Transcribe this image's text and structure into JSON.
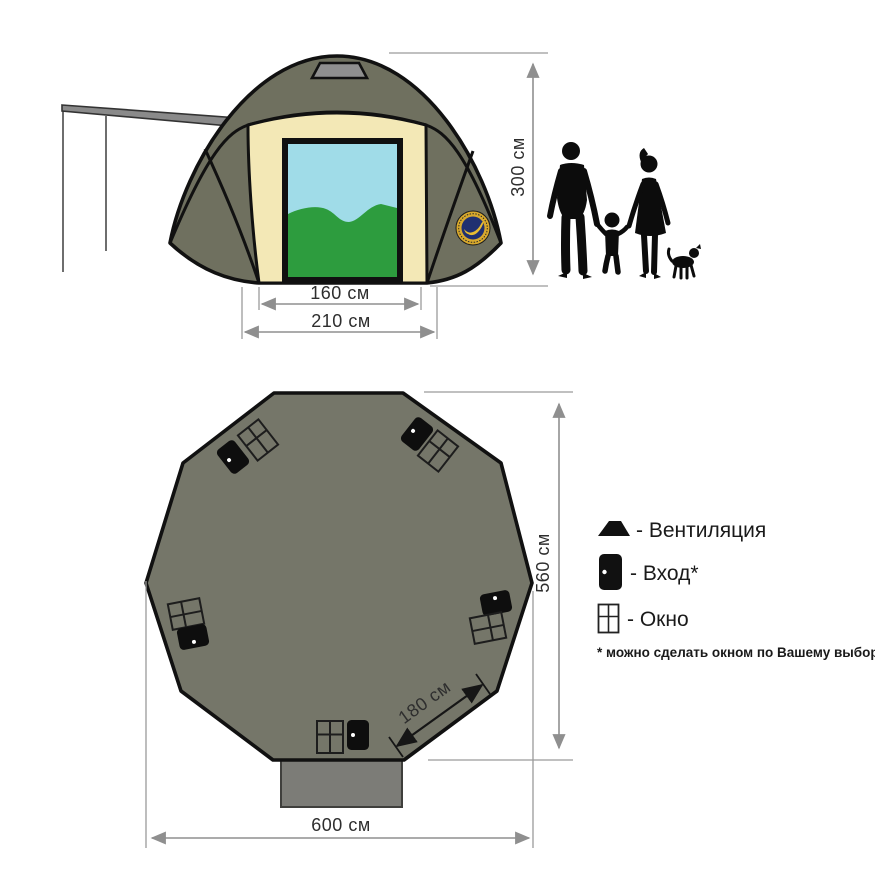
{
  "front_view": {
    "height_label": "300 см",
    "door_width_label": "160 см",
    "base_width_label": "210 см"
  },
  "floor_plan": {
    "width_label": "600 см",
    "depth_label": "560 см",
    "side_label": "180 см"
  },
  "legend": {
    "ventilation": "- Вентиляция",
    "entrance": "- Вход*",
    "window": "- Окно",
    "footnote": "* можно сделать окном по Вашему выбору"
  },
  "icons": {
    "ventilation": "vent-trapezoid-icon",
    "entrance": "door-icon",
    "window": "window-icon"
  },
  "colors": {
    "tent_fabric": "#6f705f",
    "plan_fabric": "#757669",
    "canvas_panel": "#f3e8b6",
    "sky": "#a0dce8",
    "hills": "#2d9c3e",
    "vent_gray": "#8f8f8f",
    "vestibule": "#7c7c77",
    "dimension_line": "#8f8f8f",
    "logo_gold": "#d9a92c",
    "logo_navy": "#203071"
  }
}
